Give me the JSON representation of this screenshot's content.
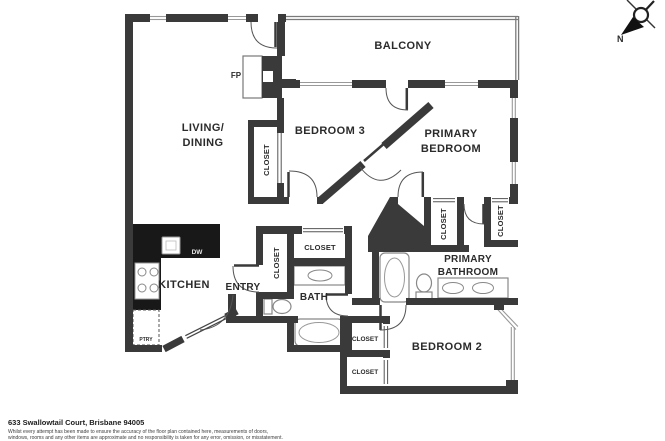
{
  "labels": {
    "balcony": "BALCONY",
    "living1": "LIVING/",
    "living2": "DINING",
    "bedroom3": "BEDROOM 3",
    "primary1": "PRIMARY",
    "primary2": "BEDROOM",
    "kitchen": "KITCHEN",
    "entry": "ENTRY",
    "bath": "BATH",
    "pbath1": "PRIMARY",
    "pbath2": "BATHROOM",
    "bedroom2": "BEDROOM 2",
    "closet": "CLOSET",
    "fireplace": "FP",
    "dishwasher": "DW",
    "pantry": "PTRY",
    "north": "N"
  },
  "footer": {
    "address": "633 Swallowtail Court, Brisbane 94005",
    "disclaimer1": "Whilst every attempt has been made to ensure the accuracy of the floor plan contained here, measurements of doors,",
    "disclaimer2": "windows, rooms and any other items are approximate and no responsibility is taken for any error, omission, or misstatement."
  },
  "colors": {
    "wall": "#3a3a3a",
    "counter": "#181818",
    "window_line": "#999999",
    "fixture_line": "#888888"
  }
}
